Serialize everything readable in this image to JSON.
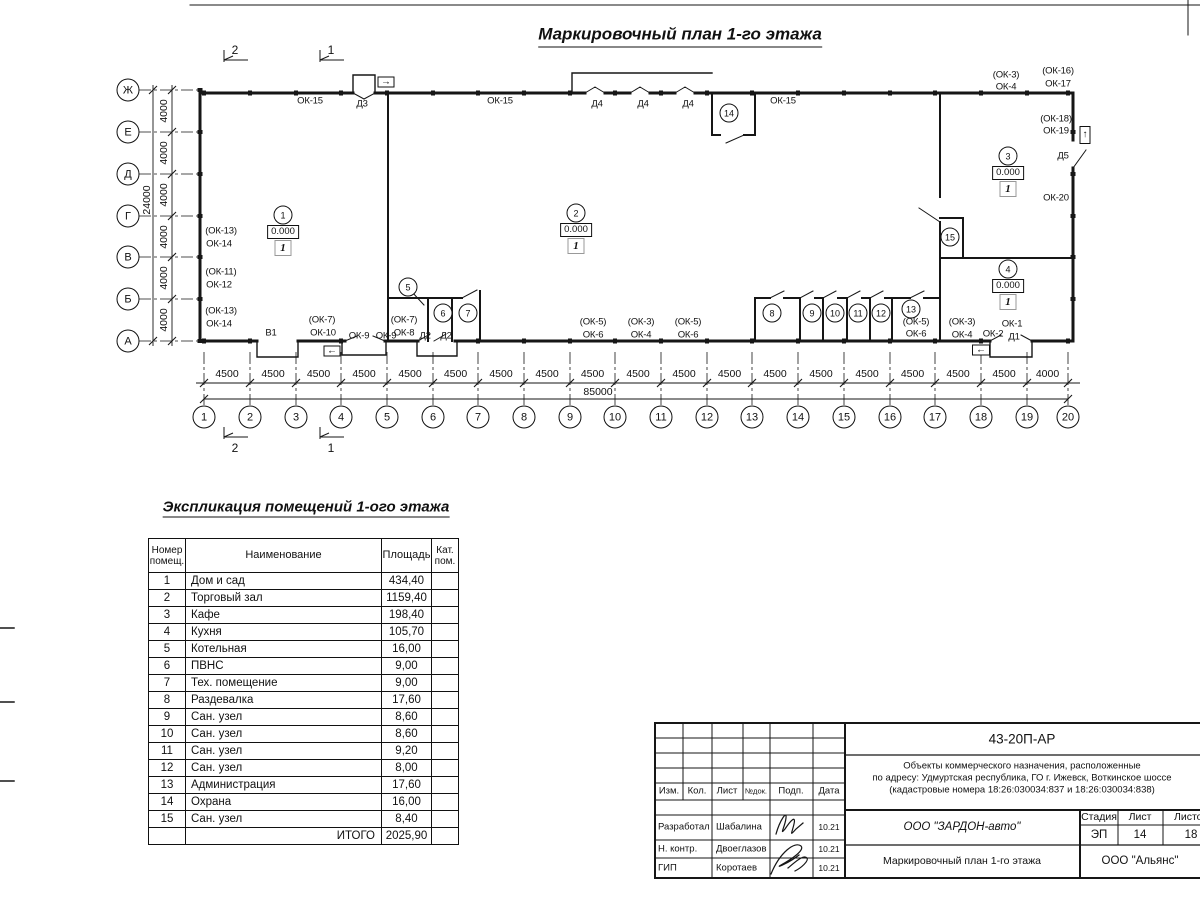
{
  "sheet": {
    "title": "Маркировочный план 1-го этажа"
  },
  "plan": {
    "axes_vertical": {
      "labels": [
        "Ж",
        "Е",
        "Д",
        "Г",
        "В",
        "Б",
        "А"
      ],
      "dims": [
        "4000",
        "4000",
        "4000",
        "4000",
        "4000",
        "4000"
      ],
      "total": "24000"
    },
    "axes_horizontal": {
      "labels": [
        "1",
        "2",
        "3",
        "4",
        "5",
        "6",
        "7",
        "8",
        "9",
        "10",
        "11",
        "12",
        "13",
        "14",
        "15",
        "16",
        "17",
        "18",
        "19",
        "20"
      ],
      "dims": [
        "4500",
        "4500",
        "4500",
        "4500",
        "4500",
        "4500",
        "4500",
        "4500",
        "4500",
        "4500",
        "4500",
        "4500",
        "4500",
        "4500",
        "4500",
        "4500",
        "4500",
        "4500",
        "4000"
      ],
      "total": "85000"
    },
    "section_markers": [
      {
        "label": "2",
        "x": 224,
        "y": 60,
        "dy": -10
      },
      {
        "label": "1",
        "x": 320,
        "y": 60,
        "dy": -10
      },
      {
        "label": "2",
        "x": 224,
        "y": 437,
        "dy": 11
      },
      {
        "label": "1",
        "x": 320,
        "y": 437,
        "dy": 11
      }
    ],
    "wall_labels": [
      {
        "text": "ОК-15",
        "x": 310,
        "y": 101
      },
      {
        "text": "Д3",
        "x": 362,
        "y": 104
      },
      {
        "text": "ОК-15",
        "x": 500,
        "y": 101
      },
      {
        "text": "Д4",
        "x": 597,
        "y": 104
      },
      {
        "text": "Д4",
        "x": 643,
        "y": 104
      },
      {
        "text": "Д4",
        "x": 688,
        "y": 104
      },
      {
        "text": "ОК-15",
        "x": 783,
        "y": 101
      },
      {
        "text": "(ОК-3)",
        "x": 1006,
        "y": 75
      },
      {
        "text": "ОК-4",
        "x": 1006,
        "y": 87
      },
      {
        "text": "(ОК-16)",
        "x": 1058,
        "y": 71
      },
      {
        "text": "ОК-17",
        "x": 1058,
        "y": 84
      },
      {
        "text": "(ОК-18)",
        "x": 1056,
        "y": 119
      },
      {
        "text": "ОК-19",
        "x": 1056,
        "y": 131
      },
      {
        "text": "Д5",
        "x": 1063,
        "y": 156
      },
      {
        "text": "ОК-20",
        "x": 1056,
        "y": 198
      },
      {
        "text": "(ОК-13)",
        "x": 221,
        "y": 231
      },
      {
        "text": "ОК-14",
        "x": 219,
        "y": 244
      },
      {
        "text": "(ОК-11)",
        "x": 221,
        "y": 272
      },
      {
        "text": "ОК-12",
        "x": 219,
        "y": 285
      },
      {
        "text": "(ОК-13)",
        "x": 221,
        "y": 311
      },
      {
        "text": "ОК-14",
        "x": 219,
        "y": 324
      },
      {
        "text": "В1",
        "x": 271,
        "y": 333
      },
      {
        "text": "(ОК-7)",
        "x": 322,
        "y": 320
      },
      {
        "text": "ОК-10",
        "x": 323,
        "y": 333
      },
      {
        "text": "ОК-9",
        "x": 359,
        "y": 336
      },
      {
        "text": "ОК-9",
        "x": 386,
        "y": 336
      },
      {
        "text": "(ОК-7)",
        "x": 404,
        "y": 320
      },
      {
        "text": "ОК-8",
        "x": 404,
        "y": 333
      },
      {
        "text": "Д2",
        "x": 425,
        "y": 336
      },
      {
        "text": "Д2",
        "x": 446,
        "y": 336
      },
      {
        "text": "(ОК-5)",
        "x": 593,
        "y": 322
      },
      {
        "text": "ОК-6",
        "x": 593,
        "y": 335
      },
      {
        "text": "(ОК-3)",
        "x": 641,
        "y": 322
      },
      {
        "text": "ОК-4",
        "x": 641,
        "y": 335
      },
      {
        "text": "(ОК-5)",
        "x": 688,
        "y": 322
      },
      {
        "text": "ОК-6",
        "x": 688,
        "y": 335
      },
      {
        "text": "(ОК-5)",
        "x": 916,
        "y": 322
      },
      {
        "text": "ОК-6",
        "x": 916,
        "y": 334
      },
      {
        "text": "(ОК-3)",
        "x": 962,
        "y": 322
      },
      {
        "text": "ОК-4",
        "x": 962,
        "y": 335
      },
      {
        "text": "ОК-1",
        "x": 1012,
        "y": 324
      },
      {
        "text": "ОК-2",
        "x": 993,
        "y": 334
      },
      {
        "text": "Д1",
        "x": 1014,
        "y": 337
      }
    ],
    "rooms": [
      {
        "num": "1",
        "x": 283,
        "y": 215,
        "elevation": "0.000",
        "floor": "1"
      },
      {
        "num": "2",
        "x": 576,
        "y": 213,
        "elevation": "0.000",
        "floor": "1"
      },
      {
        "num": "3",
        "x": 1008,
        "y": 156,
        "elevation": "0.000",
        "floor": "1"
      },
      {
        "num": "4",
        "x": 1008,
        "y": 269,
        "elevation": "0.000",
        "floor": "1"
      },
      {
        "num": "5",
        "x": 408,
        "y": 287
      },
      {
        "num": "6",
        "x": 443,
        "y": 313
      },
      {
        "num": "7",
        "x": 468,
        "y": 313
      },
      {
        "num": "8",
        "x": 772,
        "y": 313
      },
      {
        "num": "9",
        "x": 812,
        "y": 313
      },
      {
        "num": "10",
        "x": 835,
        "y": 313
      },
      {
        "num": "11",
        "x": 858,
        "y": 313
      },
      {
        "num": "12",
        "x": 881,
        "y": 313
      },
      {
        "num": "13",
        "x": 911,
        "y": 309
      },
      {
        "num": "14",
        "x": 729,
        "y": 113
      },
      {
        "num": "15",
        "x": 950,
        "y": 237
      }
    ],
    "exit_signs": [
      {
        "glyph": "→",
        "x": 386,
        "y": 82,
        "w": 17,
        "h": 11
      },
      {
        "glyph": "↑",
        "x": 1085,
        "y": 135,
        "w": 11,
        "h": 18
      },
      {
        "glyph": "←",
        "x": 332,
        "y": 351,
        "w": 17,
        "h": 11
      },
      {
        "glyph": "←",
        "x": 981,
        "y": 350,
        "w": 18,
        "h": 11
      }
    ]
  },
  "explication": {
    "title": "Экспликация помещений 1-ого этажа",
    "headers": [
      "Номер помещ.",
      "Наименование",
      "Площадь",
      "Кат. пом."
    ],
    "rows": [
      [
        "1",
        "Дом и сад",
        "434,40"
      ],
      [
        "2",
        "Торговый зал",
        "1159,40"
      ],
      [
        "3",
        "Кафе",
        "198,40"
      ],
      [
        "4",
        "Кухня",
        "105,70"
      ],
      [
        "5",
        "Котельная",
        "16,00"
      ],
      [
        "6",
        "ПВНС",
        "9,00"
      ],
      [
        "7",
        "Тех. помещение",
        "9,00"
      ],
      [
        "8",
        "Раздевалка",
        "17,60"
      ],
      [
        "9",
        "Сан. узел",
        "8,60"
      ],
      [
        "10",
        "Сан. узел",
        "8,60"
      ],
      [
        "11",
        "Сан. узел",
        "9,20"
      ],
      [
        "12",
        "Сан. узел",
        "8,00"
      ],
      [
        "13",
        "Администрация",
        "17,60"
      ],
      [
        "14",
        "Охрана",
        "16,00"
      ],
      [
        "15",
        "Сан. узел",
        "8,40"
      ]
    ],
    "total_label": "ИТОГО",
    "total_value": "2025,90"
  },
  "titleblock": {
    "doc_code": "43-20П-АР",
    "project_lines": [
      "Объекты коммерческого назначения, расположенные",
      "по адресу: Удмуртская республика, ГО г. Ижевск, Воткинское шоссе",
      "(кадастровые номера 18:26:030034:837 и 18:26:030034:838)"
    ],
    "rev_headers": [
      "Изм.",
      "Кол.",
      "Лист",
      "№док.",
      "Подп.",
      "Дата"
    ],
    "signatures": [
      {
        "role": "Разработал",
        "name": "Шабалина",
        "date": "10.21"
      },
      {
        "role": "Н. контр.",
        "name": "Двоеглазов",
        "date": "10.21"
      },
      {
        "role": "ГИП",
        "name": "Коротаев",
        "date": "10.21"
      }
    ],
    "company": "ООО \"ЗАРДОН-авто\"",
    "drawing_title": "Маркировочный план 1-го этажа",
    "stage_label": "Стадия",
    "sheet_label": "Лист",
    "sheets_label": "Листов",
    "stage": "ЭП",
    "sheet": "14",
    "sheets": "18",
    "contractor": "ООО \"Альянс\""
  }
}
